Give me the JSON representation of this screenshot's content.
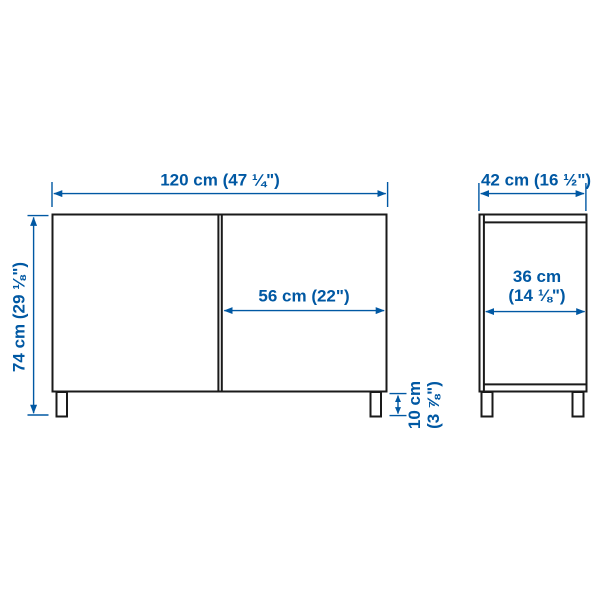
{
  "title": "Cabinet dimension diagram",
  "colors": {
    "accent": "#0058a3",
    "line": "#1a1a1a",
    "background": "#ffffff"
  },
  "views": {
    "front": {
      "name": "front-view",
      "dimensions": {
        "width": "120 cm (47 ¼\")",
        "height": "74 cm (29 ⅛\")",
        "door_width": "56 cm (22\")",
        "leg_height_line1": "10 cm",
        "leg_height_line2": "(3 ⅞\")"
      }
    },
    "side": {
      "name": "side-view",
      "dimensions": {
        "depth": "42 cm (16 ½\")",
        "inner_depth_line1": "36 cm",
        "inner_depth_line2": "(14 ⅛\")"
      }
    }
  }
}
